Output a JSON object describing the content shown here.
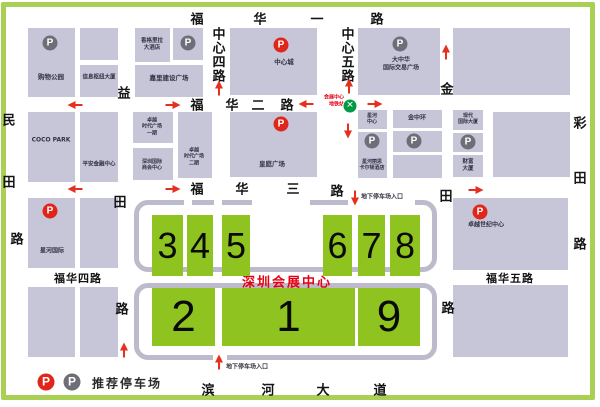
{
  "title": {
    "text": "深圳会展中心"
  },
  "legend": {
    "label": "推荐停车场"
  },
  "metro": {
    "line1": "会展中心",
    "line2": "地铁站"
  },
  "parking_entrances": {
    "label": "地下停车场入口",
    "items": [
      {
        "dir": "down",
        "ax": 355,
        "ay": 198,
        "tx": 361,
        "ty": 196
      },
      {
        "dir": "up",
        "ax": 219,
        "ay": 362,
        "tx": 226,
        "ty": 366
      }
    ]
  },
  "streets": [
    {
      "name": "福华一路",
      "labels": [
        {
          "c": "福",
          "x": 197,
          "y": 18
        },
        {
          "c": "华",
          "x": 260,
          "y": 18
        },
        {
          "c": "一",
          "x": 317,
          "y": 18
        },
        {
          "c": "路",
          "x": 377,
          "y": 18
        }
      ]
    },
    {
      "name": "中心四路",
      "labels": [
        {
          "c": "中",
          "x": 219,
          "y": 33
        },
        {
          "c": "心",
          "x": 219,
          "y": 47
        },
        {
          "c": "四",
          "x": 219,
          "y": 61
        },
        {
          "c": "路",
          "x": 219,
          "y": 75
        }
      ]
    },
    {
      "name": "中心五路",
      "labels": [
        {
          "c": "中",
          "x": 348,
          "y": 33
        },
        {
          "c": "心",
          "x": 348,
          "y": 47
        },
        {
          "c": "五",
          "x": 348,
          "y": 61
        },
        {
          "c": "路",
          "x": 348,
          "y": 75
        }
      ]
    },
    {
      "name": "福华二路",
      "labels": [
        {
          "c": "福",
          "x": 197,
          "y": 104
        },
        {
          "c": "华",
          "x": 232,
          "y": 104
        },
        {
          "c": "二",
          "x": 258,
          "y": 104
        },
        {
          "c": "路",
          "x": 287,
          "y": 104
        }
      ]
    },
    {
      "name": "民田路",
      "labels": [
        {
          "c": "民",
          "x": 9,
          "y": 119
        },
        {
          "c": "田",
          "x": 9,
          "y": 181
        },
        {
          "c": "路",
          "x": 17,
          "y": 238
        }
      ]
    },
    {
      "name": "益田路",
      "labels": [
        {
          "c": "益",
          "x": 124,
          "y": 92
        },
        {
          "c": "田",
          "x": 120,
          "y": 201
        },
        {
          "c": "路",
          "x": 122,
          "y": 308
        }
      ]
    },
    {
      "name": "金田路",
      "labels": [
        {
          "c": "金",
          "x": 447,
          "y": 88
        },
        {
          "c": "田",
          "x": 446,
          "y": 195
        },
        {
          "c": "路",
          "x": 448,
          "y": 307
        }
      ]
    },
    {
      "name": "彩田路",
      "labels": [
        {
          "c": "彩",
          "x": 580,
          "y": 122
        },
        {
          "c": "田",
          "x": 580,
          "y": 177
        },
        {
          "c": "路",
          "x": 580,
          "y": 243
        }
      ]
    },
    {
      "name": "福华三路",
      "labels": [
        {
          "c": "福",
          "x": 197,
          "y": 188
        },
        {
          "c": "华",
          "x": 242,
          "y": 188
        },
        {
          "c": "三",
          "x": 293,
          "y": 188
        },
        {
          "c": "路",
          "x": 337,
          "y": 190
        }
      ]
    },
    {
      "name": "福华四路",
      "labels": [
        {
          "c": "福华四路",
          "x": 78,
          "y": 278,
          "wide": true
        }
      ]
    },
    {
      "name": "福华五路",
      "labels": [
        {
          "c": "福华五路",
          "x": 510,
          "y": 278,
          "wide": true
        }
      ]
    },
    {
      "name": "滨河大道",
      "labels": [
        {
          "c": "滨",
          "x": 208,
          "y": 389
        },
        {
          "c": "河",
          "x": 268,
          "y": 389
        },
        {
          "c": "大",
          "x": 323,
          "y": 389
        },
        {
          "c": "道",
          "x": 380,
          "y": 389
        }
      ]
    }
  ],
  "blocks": [
    {
      "label": "购物公园",
      "x": 28,
      "y": 28,
      "w": 47,
      "h": 69,
      "p": "gray",
      "ppos": [
        50,
        43
      ],
      "lpos": [
        51,
        77
      ]
    },
    {
      "label": "",
      "x": 80,
      "y": 28,
      "w": 38,
      "h": 32
    },
    {
      "label": "信息枢纽大厦",
      "x": 80,
      "y": 65,
      "w": 38,
      "h": 32,
      "lpos": [
        99,
        78
      ],
      "fs": 5.5
    },
    {
      "label": "香格里拉\n大酒店",
      "x": 135,
      "y": 28,
      "w": 35,
      "h": 34,
      "lpos": [
        152,
        45
      ],
      "fs": 5.5
    },
    {
      "label": "",
      "x": 173,
      "y": 28,
      "w": 30,
      "h": 32,
      "p": "gray",
      "ppos": [
        188,
        43
      ]
    },
    {
      "label": "嘉里建设广场",
      "x": 135,
      "y": 65,
      "w": 68,
      "h": 32,
      "lpos": [
        169,
        78
      ]
    },
    {
      "label": "中心城",
      "x": 230,
      "y": 28,
      "w": 87,
      "h": 67,
      "p": "red",
      "ppos": [
        281,
        45
      ],
      "lpos": [
        284,
        62
      ]
    },
    {
      "label": "大中华\n国际交易广场",
      "x": 358,
      "y": 28,
      "w": 82,
      "h": 67,
      "p": "gray",
      "ppos": [
        400,
        44
      ],
      "lpos": [
        401,
        64
      ],
      "fs": 6
    },
    {
      "label": "",
      "x": 453,
      "y": 28,
      "w": 117,
      "h": 67
    },
    {
      "label": "COCO PARK",
      "x": 28,
      "y": 112,
      "w": 47,
      "h": 70,
      "lpos": [
        51,
        140
      ],
      "fs": 6
    },
    {
      "label": "平安金融中心",
      "x": 80,
      "y": 112,
      "w": 38,
      "h": 70,
      "lpos": [
        99,
        165
      ],
      "fs": 5.5
    },
    {
      "label": "卓越\n时代广场\n一期",
      "x": 133,
      "y": 112,
      "w": 40,
      "h": 31,
      "lpos": [
        152,
        127
      ],
      "fs": 5
    },
    {
      "label": "深圳国际\n商会中心",
      "x": 133,
      "y": 148,
      "w": 40,
      "h": 32,
      "lpos": [
        152,
        165
      ],
      "fs": 5
    },
    {
      "label": "卓越\n时代广场\n二期",
      "x": 178,
      "y": 112,
      "w": 34,
      "h": 66,
      "lpos": [
        194,
        157
      ],
      "fs": 5
    },
    {
      "label": "皇庭广场",
      "x": 230,
      "y": 112,
      "w": 87,
      "h": 65,
      "p": "red",
      "ppos": [
        281,
        124
      ],
      "lpos": [
        272,
        164
      ]
    },
    {
      "label": "星河\n中心",
      "x": 358,
      "y": 110,
      "w": 29,
      "h": 19,
      "lpos": [
        372,
        119
      ],
      "fs": 5
    },
    {
      "label": "星河丽思\n卡尔顿酒店",
      "x": 358,
      "y": 132,
      "w": 29,
      "h": 46,
      "p": "gray",
      "ppos": [
        372,
        141
      ],
      "lpos": [
        372,
        165
      ],
      "fs": 5
    },
    {
      "label": "金中环",
      "x": 393,
      "y": 110,
      "w": 49,
      "h": 18,
      "lpos": [
        417,
        118
      ],
      "fs": 6
    },
    {
      "label": "",
      "x": 393,
      "y": 131,
      "w": 49,
      "h": 21,
      "p": "gray",
      "ppos": [
        414,
        141
      ]
    },
    {
      "label": "",
      "x": 393,
      "y": 155,
      "w": 49,
      "h": 23
    },
    {
      "label": "现代\n国际大厦",
      "x": 453,
      "y": 110,
      "w": 30,
      "h": 20,
      "lpos": [
        468,
        119
      ],
      "fs": 5
    },
    {
      "label": "",
      "x": 453,
      "y": 133,
      "w": 30,
      "h": 19,
      "p": "gray",
      "ppos": [
        468,
        142
      ]
    },
    {
      "label": "财富\n大厦",
      "x": 453,
      "y": 155,
      "w": 30,
      "h": 22,
      "lpos": [
        468,
        166
      ],
      "fs": 5.5
    },
    {
      "label": "",
      "x": 493,
      "y": 112,
      "w": 77,
      "h": 65
    },
    {
      "label": "星河国际",
      "x": 28,
      "y": 198,
      "w": 47,
      "h": 70,
      "p": "red",
      "ppos": [
        50,
        211
      ],
      "lpos": [
        52,
        251
      ],
      "fs": 6
    },
    {
      "label": "",
      "x": 80,
      "y": 198,
      "w": 38,
      "h": 70
    },
    {
      "label": "卓越世纪中心",
      "x": 453,
      "y": 198,
      "w": 115,
      "h": 72,
      "p": "red",
      "ppos": [
        480,
        212
      ],
      "lpos": [
        486,
        225
      ],
      "fs": 6
    },
    {
      "label": "",
      "x": 28,
      "y": 287,
      "w": 47,
      "h": 70
    },
    {
      "label": "",
      "x": 80,
      "y": 287,
      "w": 38,
      "h": 70
    },
    {
      "label": "",
      "x": 453,
      "y": 285,
      "w": 115,
      "h": 72
    }
  ],
  "halls": [
    {
      "n": "3",
      "x": 152,
      "y": 215,
      "w": 31,
      "h": 61,
      "fs": 36
    },
    {
      "n": "4",
      "x": 187,
      "y": 215,
      "w": 26,
      "h": 61,
      "fs": 36
    },
    {
      "n": "5",
      "x": 222,
      "y": 215,
      "w": 28,
      "h": 61,
      "fs": 36
    },
    {
      "n": "6",
      "x": 323,
      "y": 215,
      "w": 29,
      "h": 61,
      "fs": 36
    },
    {
      "n": "7",
      "x": 358,
      "y": 215,
      "w": 27,
      "h": 61,
      "fs": 36
    },
    {
      "n": "8",
      "x": 390,
      "y": 215,
      "w": 30,
      "h": 61,
      "fs": 36
    },
    {
      "n": "2",
      "x": 152,
      "y": 288,
      "w": 63,
      "h": 58,
      "fs": 44
    },
    {
      "n": "1",
      "x": 222,
      "y": 288,
      "w": 133,
      "h": 58,
      "fs": 44
    },
    {
      "n": "9",
      "x": 358,
      "y": 288,
      "w": 62,
      "h": 58,
      "fs": 44
    }
  ],
  "arrows": [
    {
      "dir": "left",
      "x": 75,
      "y": 105
    },
    {
      "dir": "right",
      "x": 173,
      "y": 105
    },
    {
      "dir": "left",
      "x": 306,
      "y": 104
    },
    {
      "dir": "right",
      "x": 375,
      "y": 104
    },
    {
      "dir": "up",
      "x": 219,
      "y": 88
    },
    {
      "dir": "up",
      "x": 349,
      "y": 86
    },
    {
      "dir": "down",
      "x": 348,
      "y": 131
    },
    {
      "dir": "up",
      "x": 446,
      "y": 52
    },
    {
      "dir": "left",
      "x": 75,
      "y": 189
    },
    {
      "dir": "right",
      "x": 173,
      "y": 189
    },
    {
      "dir": "right",
      "x": 476,
      "y": 190
    },
    {
      "dir": "up",
      "x": 124,
      "y": 350
    }
  ],
  "colors": {
    "hall_green": "#8fc31f",
    "block_gray": "#c7c5d8",
    "road_gray": "#bdbbcb",
    "accent_red": "#e60012",
    "parking_gray": "#6e6e78",
    "frame_green": "#a9cf55",
    "metro_green": "#009944"
  }
}
